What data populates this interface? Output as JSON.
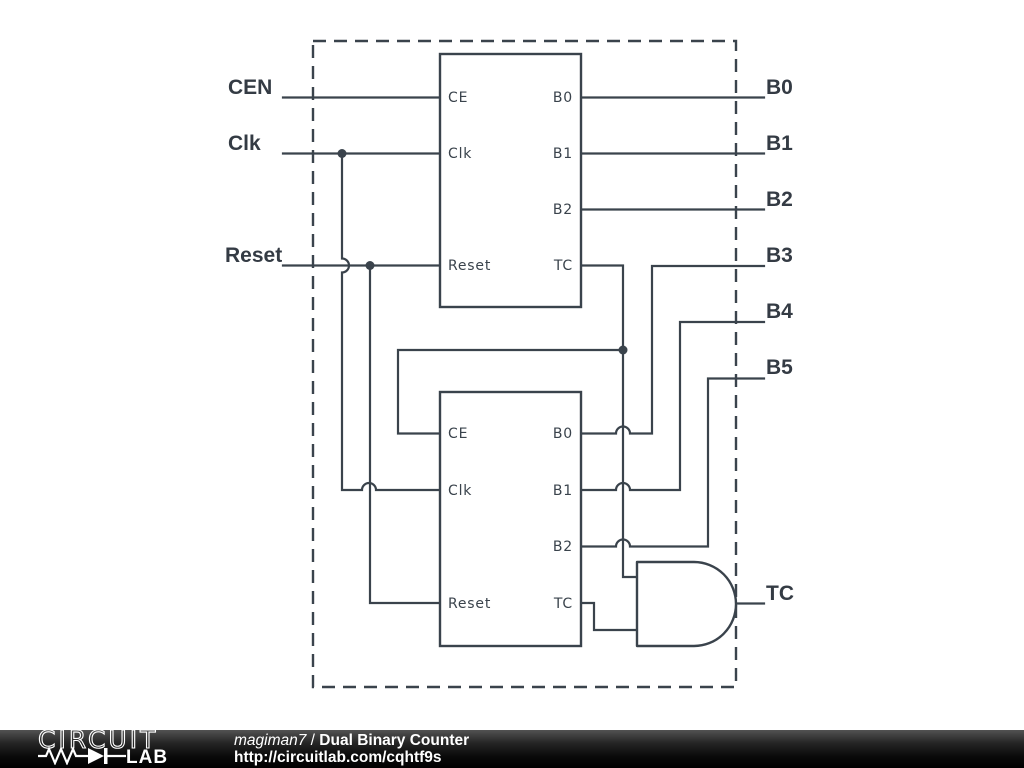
{
  "schematic": {
    "inputs": [
      {
        "label": "CEN"
      },
      {
        "label": "Clk"
      },
      {
        "label": "Reset"
      }
    ],
    "outputs": [
      {
        "label": "B0"
      },
      {
        "label": "B1"
      },
      {
        "label": "B2"
      },
      {
        "label": "B3"
      },
      {
        "label": "B4"
      },
      {
        "label": "B5"
      }
    ],
    "tc_output": {
      "label": "TC"
    },
    "blocks": [
      {
        "id": "counter-1",
        "pins_left": [
          "CE",
          "Clk",
          "Reset"
        ],
        "pins_right": [
          "B0",
          "B1",
          "B2",
          "TC"
        ]
      },
      {
        "id": "counter-2",
        "pins_left": [
          "CE",
          "Clk",
          "Reset"
        ],
        "pins_right": [
          "B0",
          "B1",
          "B2",
          "TC"
        ]
      }
    ],
    "gate": {
      "type": "AND"
    },
    "colors": {
      "wire": "#3a434c",
      "label": "#343b44"
    }
  },
  "footer": {
    "logo": {
      "top": "CIRCUIT",
      "bottom": "LAB"
    },
    "author": "magiman7",
    "separator": " / ",
    "title": "Dual Binary Counter",
    "url": "http://circuitlab.com/cqhtf9s"
  }
}
